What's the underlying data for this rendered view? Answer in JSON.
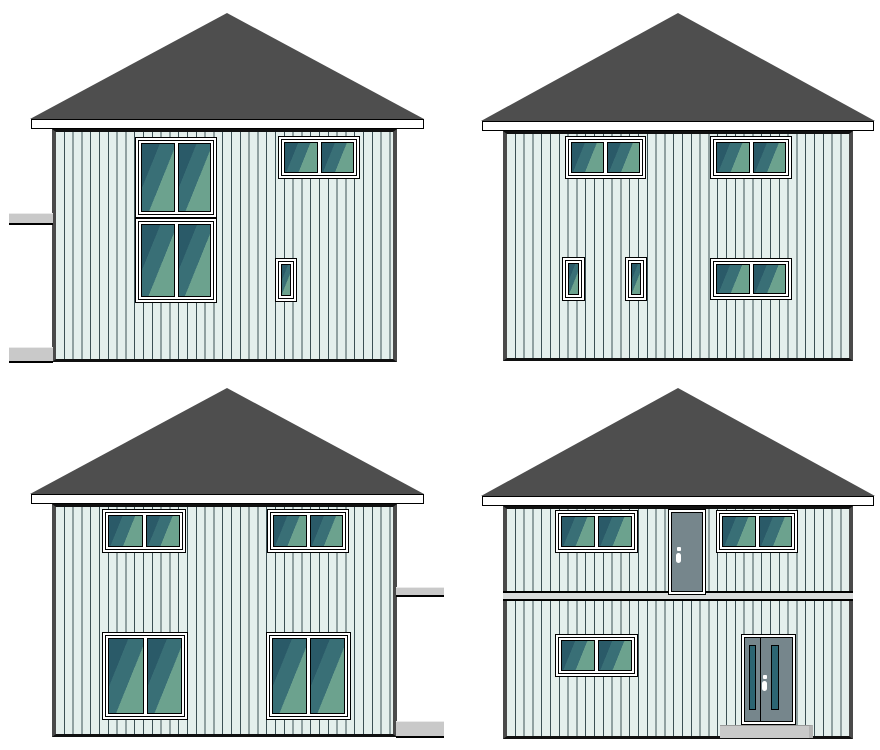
{
  "canvas": {
    "width": 880,
    "height": 750
  },
  "palette": {
    "background": "#ffffff",
    "roof": "#4e4e4e",
    "outline": "#000000",
    "fascia": "#ffffff",
    "wall": "#e4efec",
    "siding_line": "#3c5054",
    "corner_board": "#4a4a4a",
    "frame_white": "#ffffff",
    "glass_dark": "#2a5a68",
    "glass_mid": "#396f76",
    "glass_light": "#6ca28e",
    "door_gray": "#76868c",
    "door_glass": "#2c6572",
    "concrete_gray": "#c9c9c9",
    "belt_gray": "#d9dbdb"
  },
  "elevations": [
    {
      "id": "top-left",
      "cell": {
        "x": 0,
        "y": 0,
        "w": 440,
        "h": 375
      },
      "roof": {
        "x": 30,
        "y": 13,
        "w": 394,
        "h": 106
      },
      "fascia": {
        "x": 31,
        "y": 119,
        "w": 393,
        "h": 10
      },
      "wall": {
        "x": 52,
        "y": 129,
        "w": 345,
        "h": 233
      },
      "windows": [
        {
          "name": "stacked-window-upper",
          "x": 135,
          "y": 137,
          "w": 82,
          "h": 81,
          "panes": 2
        },
        {
          "name": "stacked-window-lower",
          "x": 135,
          "y": 218,
          "w": 82,
          "h": 85,
          "panes": 2
        },
        {
          "name": "double-window-upper-right",
          "x": 278,
          "y": 136,
          "w": 82,
          "h": 43,
          "panes": 2
        },
        {
          "name": "small-window-lower-right",
          "x": 275,
          "y": 258,
          "w": 22,
          "h": 44,
          "panes": 1
        }
      ],
      "doors": [],
      "ledges": [
        {
          "name": "side-ledge-upper",
          "x": 9,
          "y": 213,
          "w": 44,
          "h": 12
        },
        {
          "name": "side-ledge-lower",
          "x": 9,
          "y": 347,
          "w": 44,
          "h": 16
        }
      ]
    },
    {
      "id": "top-right",
      "cell": {
        "x": 440,
        "y": 0,
        "w": 440,
        "h": 375
      },
      "roof": {
        "x": 41,
        "y": 13,
        "w": 394,
        "h": 108
      },
      "fascia": {
        "x": 42,
        "y": 121,
        "w": 392,
        "h": 10
      },
      "wall": {
        "x": 63,
        "y": 131,
        "w": 350,
        "h": 230
      },
      "windows": [
        {
          "name": "double-window-upper-left",
          "x": 125,
          "y": 136,
          "w": 81,
          "h": 43,
          "panes": 2
        },
        {
          "name": "double-window-upper-right",
          "x": 270,
          "y": 136,
          "w": 82,
          "h": 43,
          "panes": 2
        },
        {
          "name": "small-window-lower-left",
          "x": 122,
          "y": 257,
          "w": 23,
          "h": 44,
          "panes": 1
        },
        {
          "name": "small-window-lower-mid",
          "x": 185,
          "y": 257,
          "w": 22,
          "h": 44,
          "panes": 1
        },
        {
          "name": "double-window-lower-right",
          "x": 270,
          "y": 258,
          "w": 82,
          "h": 42,
          "panes": 2
        }
      ],
      "doors": [],
      "ledges": []
    },
    {
      "id": "bottom-left",
      "cell": {
        "x": 0,
        "y": 375,
        "w": 440,
        "h": 375
      },
      "roof": {
        "x": 30,
        "y": 13,
        "w": 394,
        "h": 106
      },
      "fascia": {
        "x": 31,
        "y": 119,
        "w": 393,
        "h": 10
      },
      "wall": {
        "x": 52,
        "y": 129,
        "w": 345,
        "h": 233
      },
      "windows": [
        {
          "name": "double-window-upper-left",
          "x": 102,
          "y": 134,
          "w": 84,
          "h": 44,
          "panes": 2
        },
        {
          "name": "double-window-upper-right",
          "x": 267,
          "y": 134,
          "w": 82,
          "h": 44,
          "panes": 2
        },
        {
          "name": "large-window-lower-left",
          "x": 102,
          "y": 257,
          "w": 86,
          "h": 88,
          "panes": 2
        },
        {
          "name": "large-window-lower-right",
          "x": 266,
          "y": 257,
          "w": 85,
          "h": 88,
          "panes": 2
        }
      ],
      "doors": [],
      "ledges": [
        {
          "name": "side-ledge-upper",
          "x": 396,
          "y": 212,
          "w": 48,
          "h": 10
        },
        {
          "name": "side-ledge-lower",
          "x": 396,
          "y": 346,
          "w": 48,
          "h": 17
        }
      ]
    },
    {
      "id": "bottom-right",
      "cell": {
        "x": 440,
        "y": 375,
        "w": 440,
        "h": 375
      },
      "roof": {
        "x": 41,
        "y": 13,
        "w": 394,
        "h": 108
      },
      "fascia": {
        "x": 42,
        "y": 121,
        "w": 392,
        "h": 10
      },
      "wall": {
        "x": 63,
        "y": 131,
        "w": 350,
        "h": 233
      },
      "belt": {
        "x": 63,
        "y": 216,
        "w": 350,
        "h": 10
      },
      "step": {
        "x": 280,
        "y": 350,
        "w": 93,
        "h": 13
      },
      "windows": [
        {
          "name": "double-window-upper-left",
          "x": 115,
          "y": 135,
          "w": 83,
          "h": 43,
          "panes": 2
        },
        {
          "name": "double-window-upper-right",
          "x": 276,
          "y": 135,
          "w": 82,
          "h": 43,
          "panes": 2
        },
        {
          "name": "double-window-lower-left",
          "x": 115,
          "y": 259,
          "w": 83,
          "h": 43,
          "panes": 2
        }
      ],
      "doors": [
        {
          "name": "balcony-door",
          "type": "slab",
          "x": 228,
          "y": 134,
          "w": 38,
          "h": 86,
          "handle": {
            "left_pct": 12,
            "top_pct": 44
          }
        },
        {
          "name": "front-entry-door",
          "type": "entry",
          "x": 301,
          "y": 259,
          "w": 55,
          "h": 91,
          "split_pct": 31,
          "glass": [
            {
              "left_pct": 8,
              "width_pct": 15,
              "top_pct": 9,
              "height_pct": 78
            },
            {
              "left_pct": 55,
              "width_pct": 17,
              "top_pct": 9,
              "height_pct": 78
            }
          ],
          "handle": {
            "left_pct": 36,
            "top_pct": 45
          }
        }
      ],
      "ledges": []
    }
  ]
}
